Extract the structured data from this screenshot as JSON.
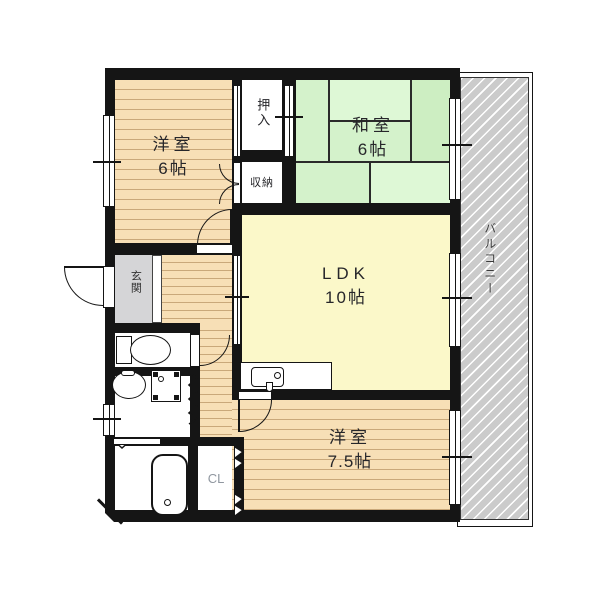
{
  "plan_title": "2LDK apartment floor plan",
  "rooms": {
    "western1": {
      "label": "洋室",
      "size": "6帖"
    },
    "oshiire": {
      "label": "押入"
    },
    "shuno": {
      "label": "収納"
    },
    "washitsu": {
      "label": "和室",
      "size": "6帖"
    },
    "ldk": {
      "label": "LDK",
      "size": "10帖"
    },
    "genkan": {
      "label": "玄関"
    },
    "balcony": {
      "label": "バルコニー"
    },
    "western2": {
      "label": "洋室",
      "size": "7.5帖"
    },
    "closet": {
      "label": "CL"
    }
  },
  "colors": {
    "wall": "#151515",
    "wood_floor": "#f7dfb6",
    "wood_line": "#c9a87a",
    "tatami_green": "#d4f2cb",
    "tatami_light": "#def8d6",
    "closet_pink": "#f6c6cc",
    "ldk_yellow": "#fbf8c9",
    "tile_blue": "#c0d4f2",
    "genkan_gray": "#d5d5d7",
    "balcony_gray": "#cbcbcb",
    "cl_text": "#9097a0"
  }
}
